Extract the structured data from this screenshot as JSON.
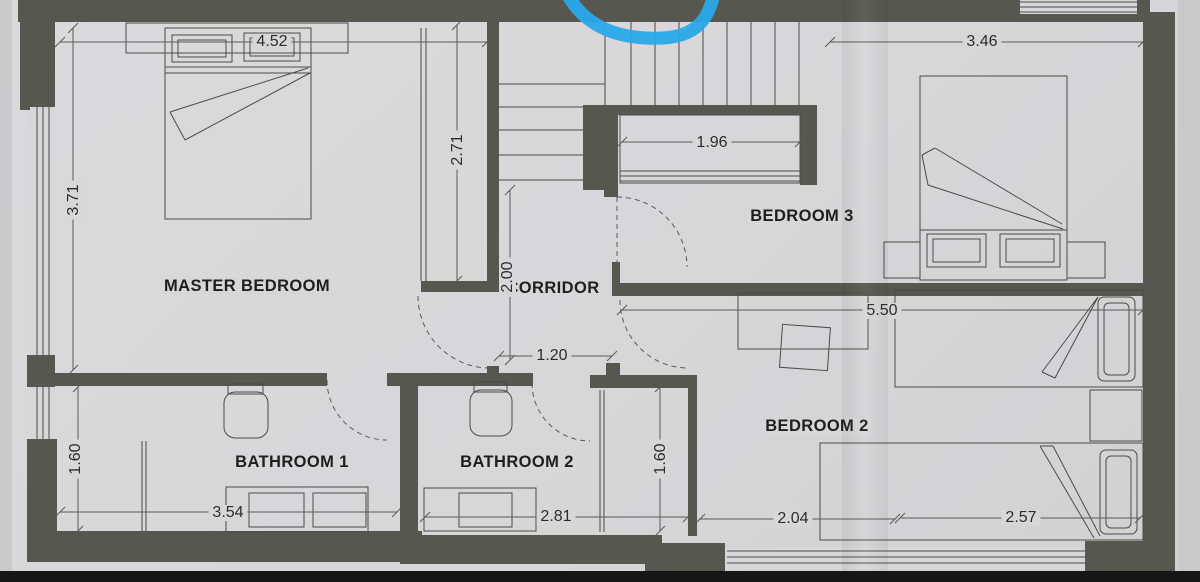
{
  "meta": {
    "type": "floor-plan",
    "style": "scanned architectural drawing"
  },
  "rooms": {
    "master_bedroom": {
      "label": "MASTER BEDROOM"
    },
    "corridor": {
      "label": "CORRIDOR"
    },
    "bedroom_3": {
      "label": "BEDROOM 3"
    },
    "bedroom_2": {
      "label": "BEDROOM 2"
    },
    "bathroom_1": {
      "label": "BATHROOM 1"
    },
    "bathroom_2": {
      "label": "BATHROOM 2"
    }
  },
  "dimensions": {
    "master_width": {
      "value": "4.52",
      "orientation": "horizontal"
    },
    "master_depth": {
      "value": "3.71",
      "orientation": "vertical"
    },
    "master_wardrobe": {
      "value": "2.71",
      "orientation": "vertical"
    },
    "closet_width": {
      "value": "1.96",
      "orientation": "horizontal"
    },
    "bedroom3_width": {
      "value": "3.46",
      "orientation": "horizontal"
    },
    "corridor_length": {
      "value": "2.00",
      "orientation": "vertical"
    },
    "corridor_width": {
      "value": "1.20",
      "orientation": "horizontal"
    },
    "bedroom2_width": {
      "value": "5.50",
      "orientation": "horizontal"
    },
    "bathroom1_depth": {
      "value": "1.60",
      "orientation": "vertical"
    },
    "bathroom2_depth": {
      "value": "1.60",
      "orientation": "vertical"
    },
    "bathroom1_width": {
      "value": "3.54",
      "orientation": "horizontal"
    },
    "bathroom2_width": {
      "value": "2.81",
      "orientation": "horizontal"
    },
    "bedroom2_opening": {
      "value": "2.04",
      "orientation": "horizontal"
    },
    "bedroom2_bed_span": {
      "value": "2.57",
      "orientation": "horizontal"
    }
  },
  "annotations": {
    "pen_stroke": {
      "kind": "handwritten marker curve",
      "color": "#2aa9e9"
    }
  },
  "colors": {
    "wall": "#57564f",
    "paper": "#d8d6d9",
    "linework": "#4c4b47",
    "pen": "#2aa9e9",
    "scan_edge": "#161616"
  }
}
